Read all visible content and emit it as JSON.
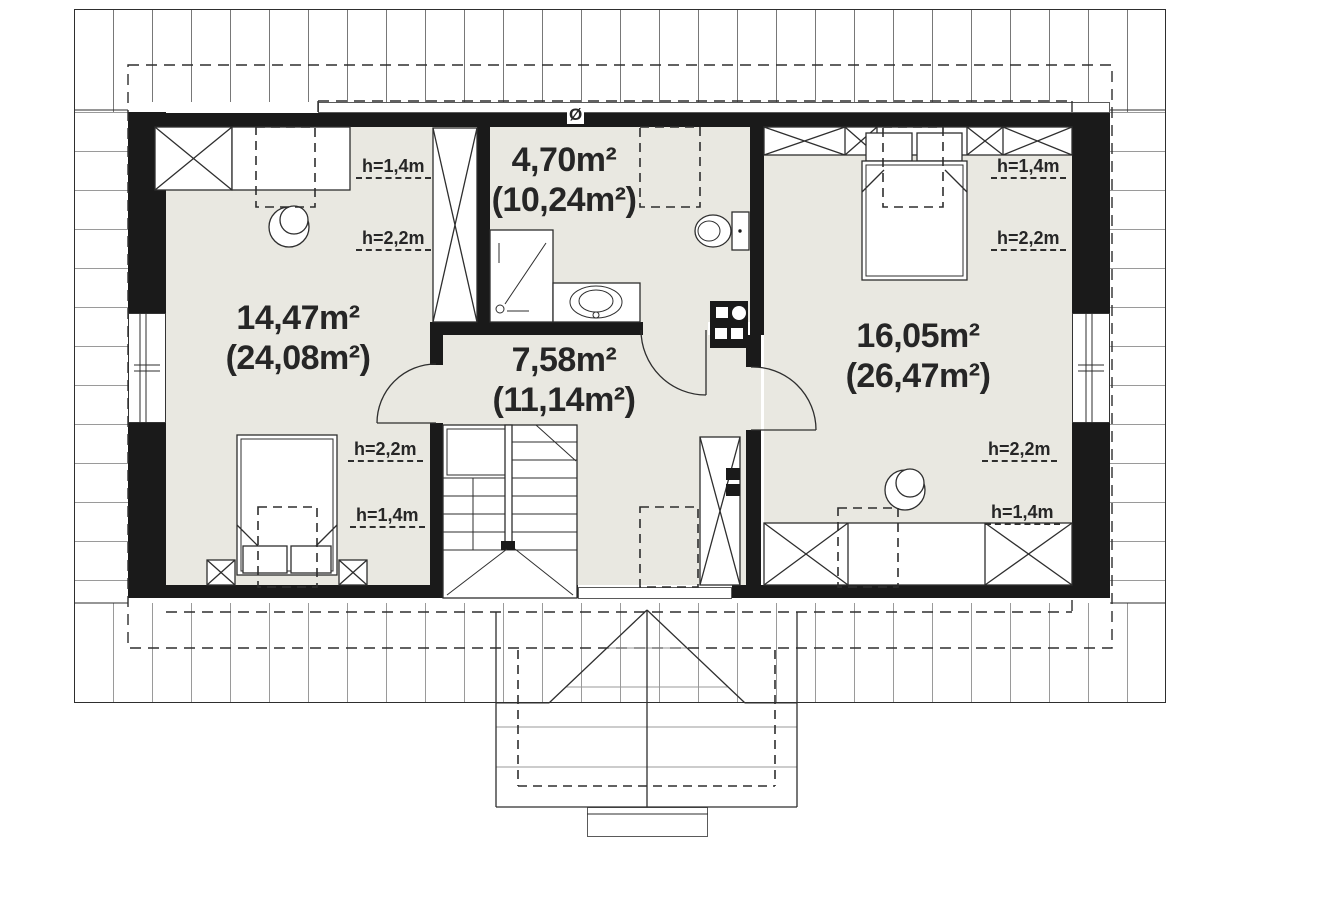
{
  "document_name": "attic-floor-plan",
  "rooms": [
    {
      "name": "bedroom-left",
      "area": "14,47m²",
      "area_total": "(24,08m²)"
    },
    {
      "name": "bathroom",
      "area": "4,70m²",
      "area_total": "(10,24m²)"
    },
    {
      "name": "hall-staircase",
      "area": "7,58m²",
      "area_total": "(11,14m²)"
    },
    {
      "name": "bedroom-right",
      "area": "16,05m²",
      "area_total": "(26,47m²)"
    }
  ],
  "height_labels": [
    "h=1,4m",
    "h=2,2m",
    "h=2,2m",
    "h=1,4m",
    "h=1,4m",
    "h=2,2m",
    "h=2,2m",
    "h=1,4m"
  ],
  "vent_symbol": "Ø",
  "colors": {
    "floor": "#e9e8e1",
    "wall": "#1a1a1a",
    "line": "#2e2e2e",
    "text": "#262626",
    "hatch-dark": "#787878",
    "hatch-light": "#9a9a9a"
  }
}
